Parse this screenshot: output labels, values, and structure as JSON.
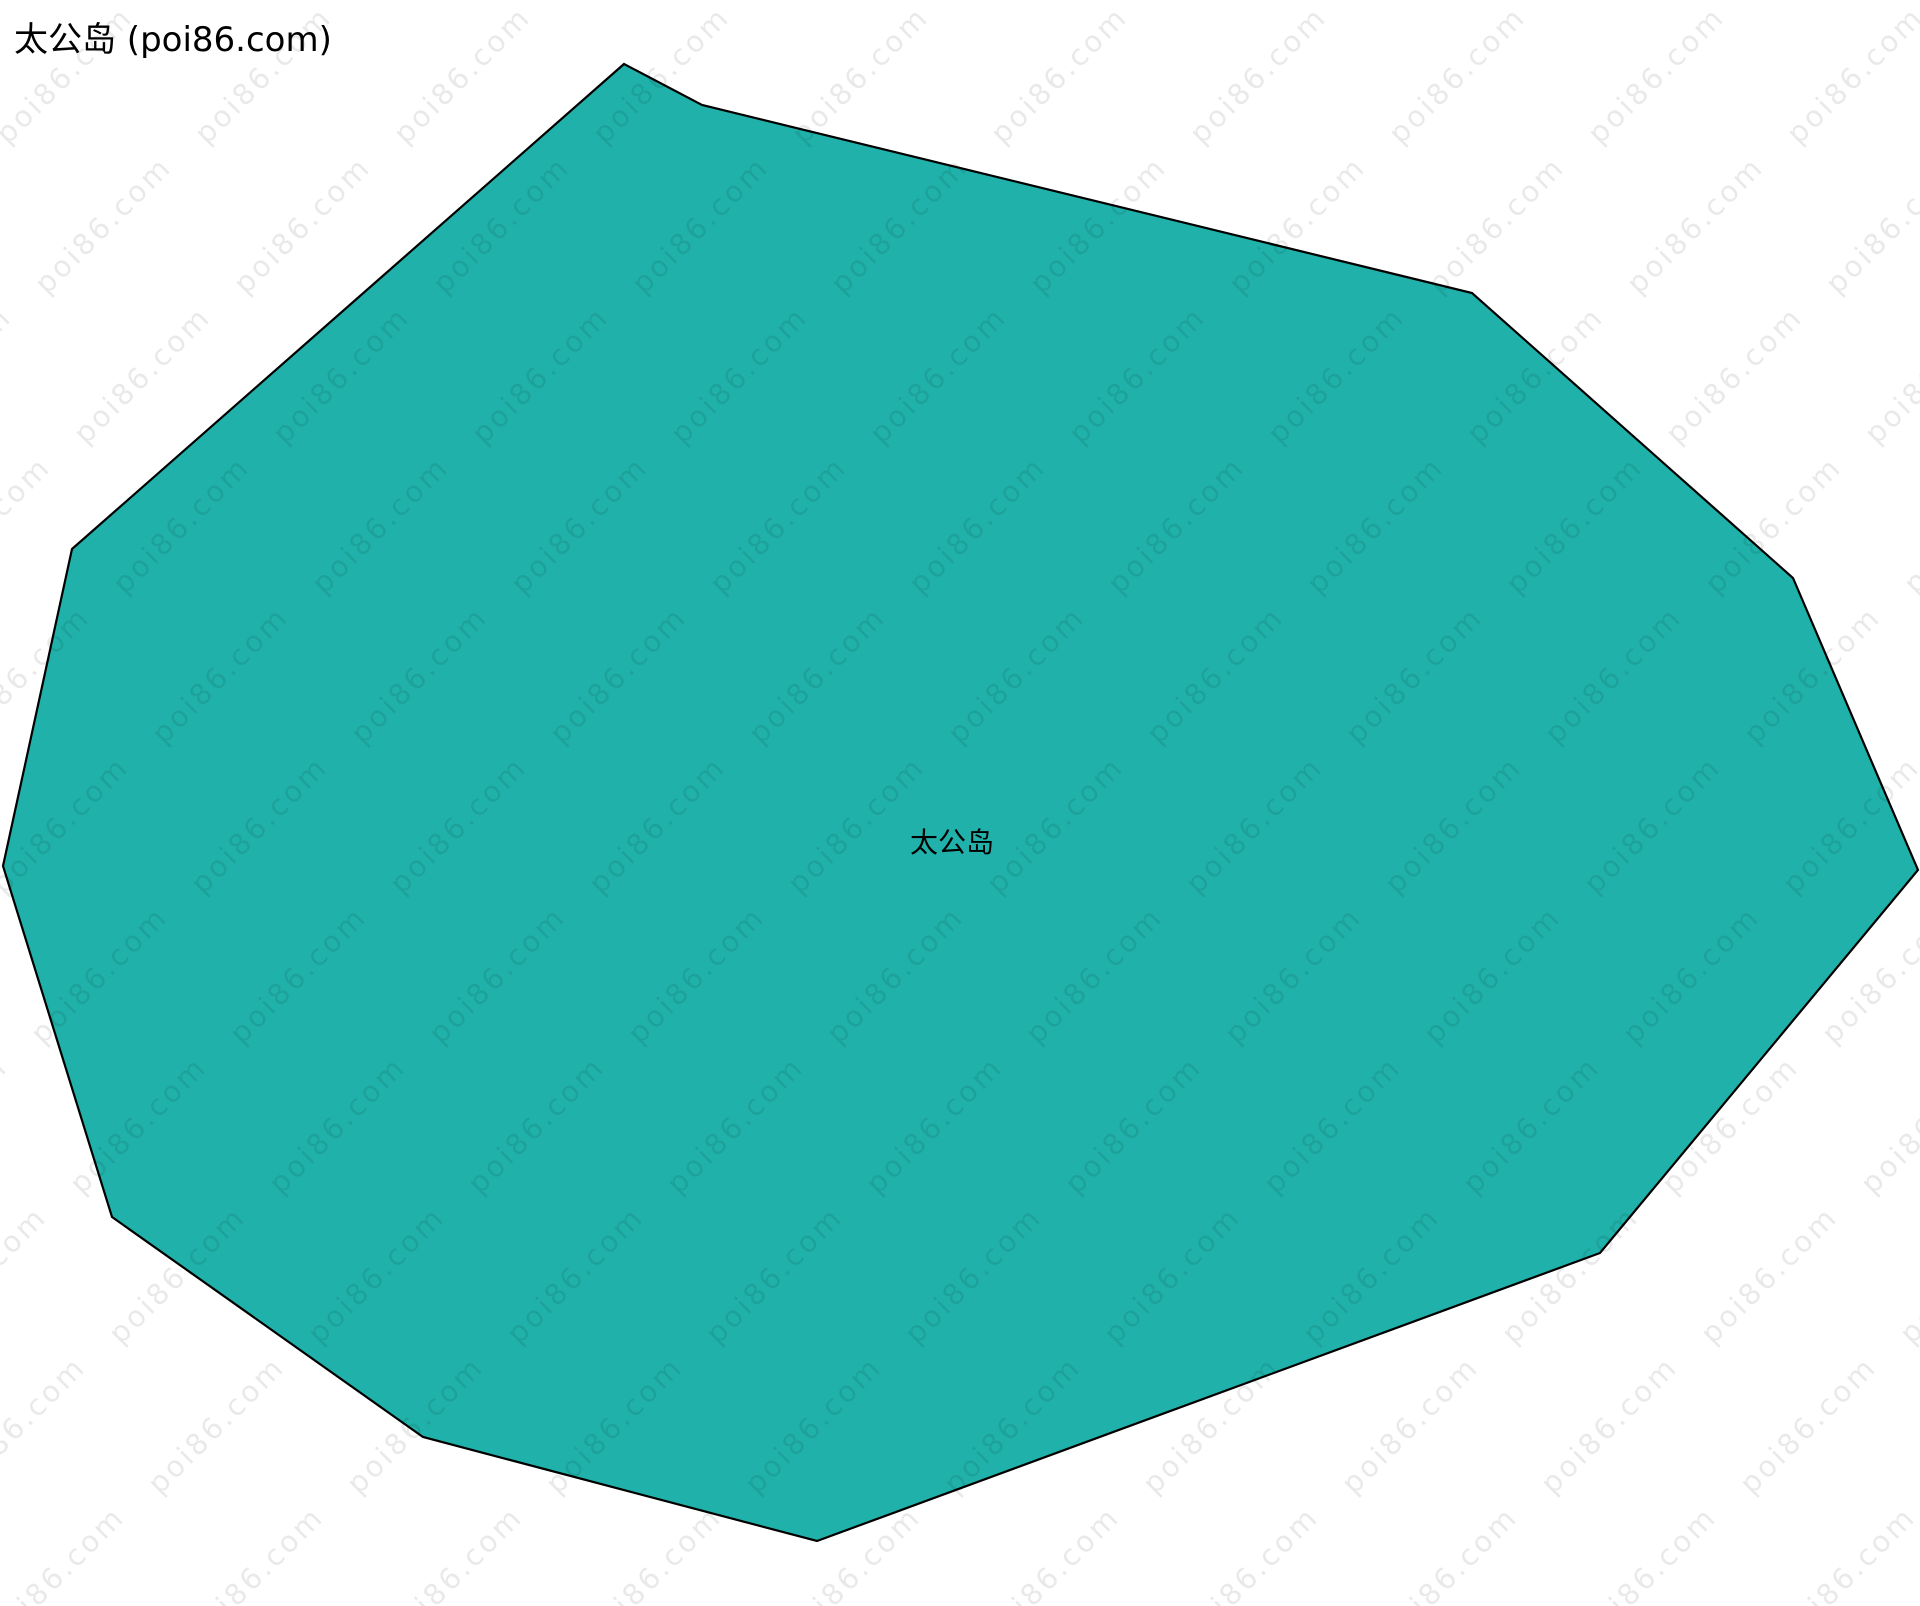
{
  "page": {
    "title": "太公岛 (poi86.com)"
  },
  "map": {
    "island_label": "太公岛",
    "label_position": {
      "x": 952,
      "y": 841
    },
    "fill_color": "#20b2aa",
    "stroke_color": "#000000",
    "stroke_width": 2.2,
    "canvas": {
      "width": 1920,
      "height": 1606
    },
    "polygon_points": [
      [
        624,
        64
      ],
      [
        702,
        105
      ],
      [
        1472,
        293
      ],
      [
        1793,
        578
      ],
      [
        1918,
        870
      ],
      [
        1600,
        1253
      ],
      [
        817,
        1541
      ],
      [
        423,
        1437
      ],
      [
        112,
        1217
      ],
      [
        3,
        866
      ],
      [
        72,
        549
      ]
    ]
  },
  "watermark": {
    "text": "poi86.com",
    "grid": {
      "pitch_x": 199,
      "pitch_y": 150,
      "row_shift": 39,
      "base_x": 64,
      "base_y": 75
    }
  }
}
